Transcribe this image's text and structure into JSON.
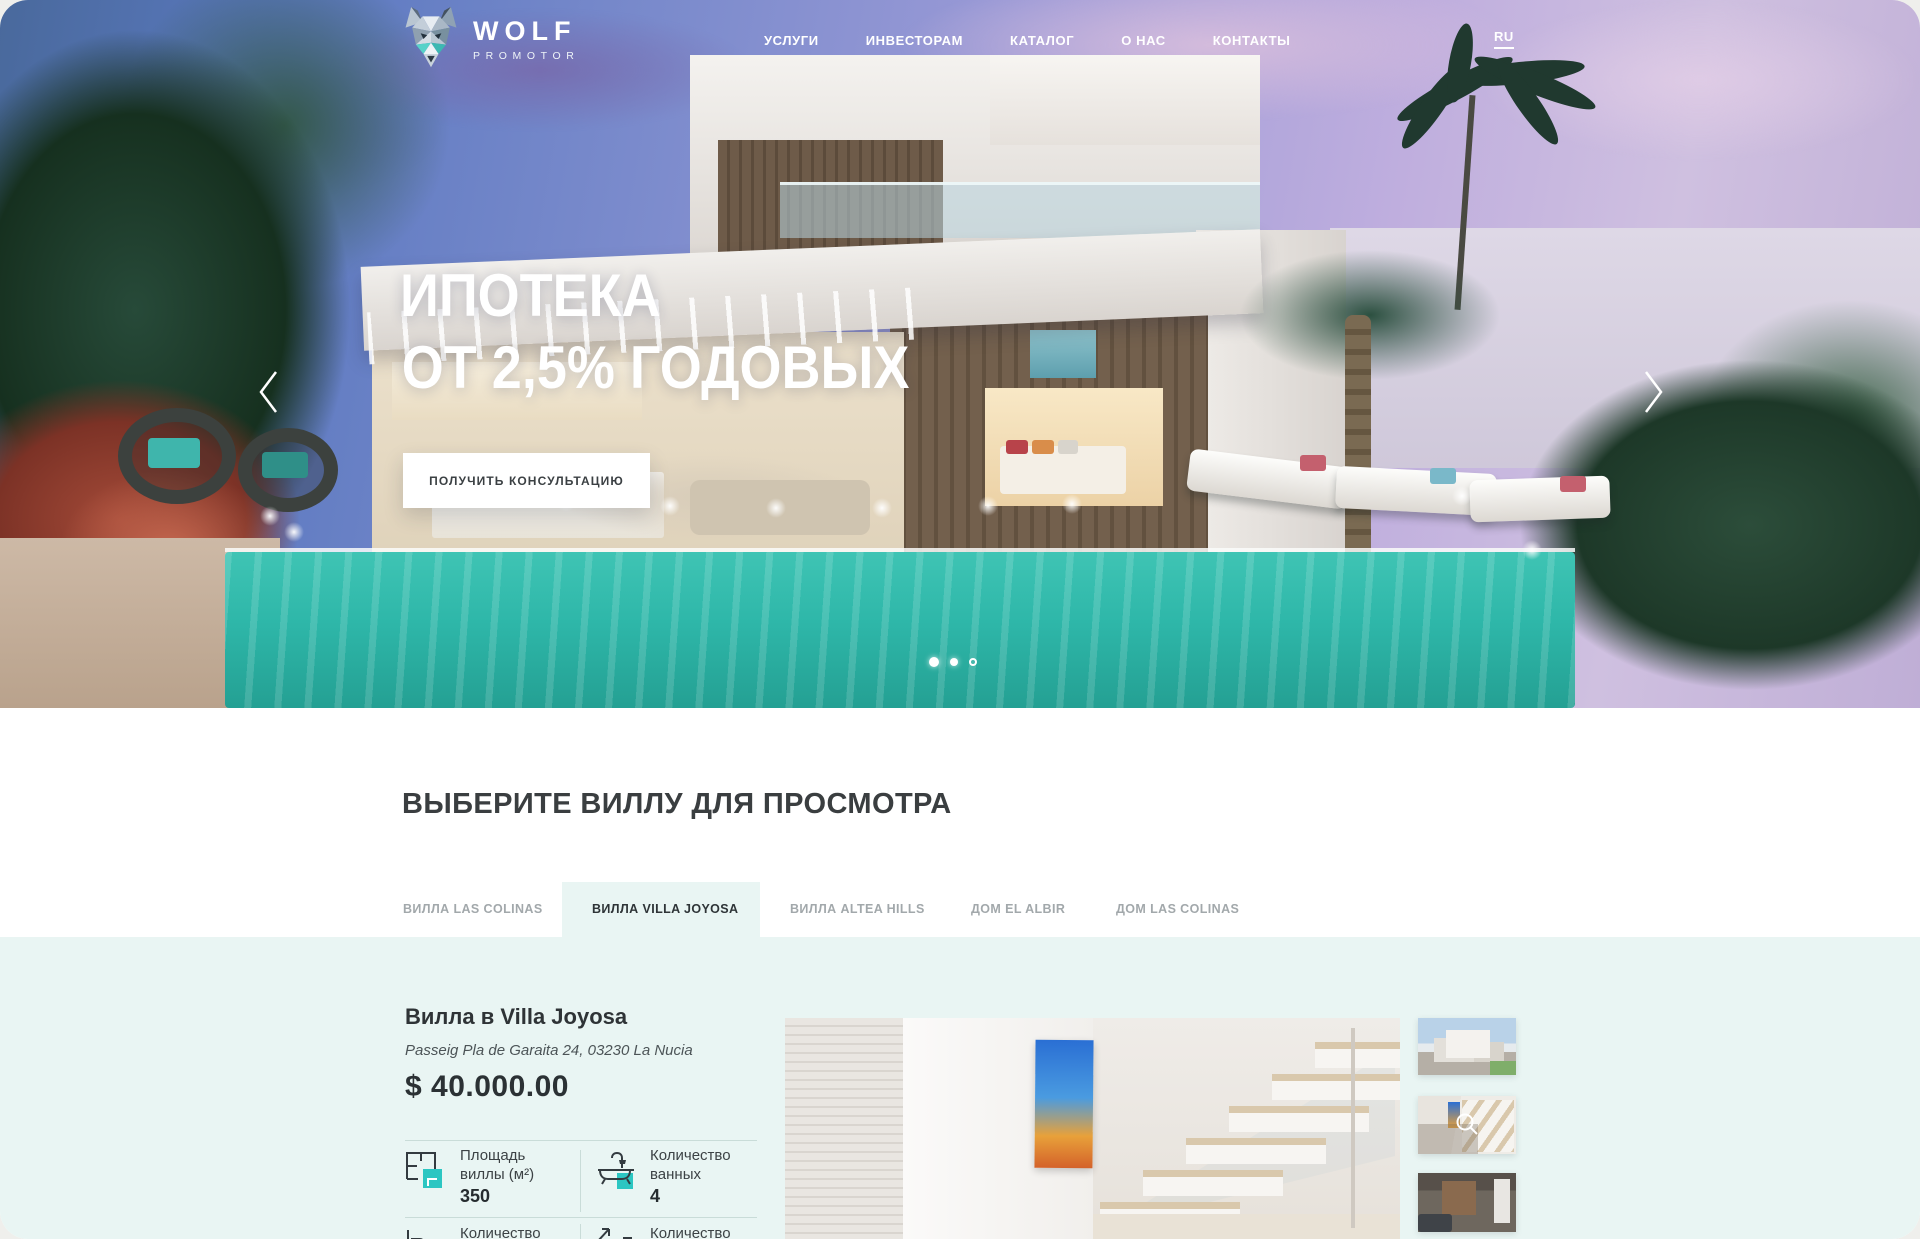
{
  "brand": {
    "name": "WOLF",
    "tagline": "PROMOTOR"
  },
  "header": {
    "nav_items": [
      {
        "label": "УСЛУГИ"
      },
      {
        "label": "ИНВЕСТОРАМ"
      },
      {
        "label": "КАТАЛОГ"
      },
      {
        "label": "О НАС"
      },
      {
        "label": "КОНТАКТЫ"
      }
    ],
    "language": "RU"
  },
  "hero": {
    "title_line1": "ИПОТЕКА",
    "title_line2": "ОТ 2,5% ГОДОВЫХ",
    "cta_label": "ПОЛУЧИТЬ КОНСУЛЬТАЦИЮ",
    "carousel": {
      "dots": [
        {
          "state": "active"
        },
        {
          "state": "solid"
        },
        {
          "state": "ring"
        }
      ]
    }
  },
  "section": {
    "heading": "ВЫБЕРИТЕ ВИЛЛУ ДЛЯ ПРОСМОТРА",
    "tabs": [
      {
        "label": "ВИЛЛА LAS COLINAS",
        "active": false
      },
      {
        "label": "ВИЛЛА VILLA JOYOSA",
        "active": true
      },
      {
        "label": "ВИЛЛА ALTEA HILLS",
        "active": false
      },
      {
        "label": "ДОМ EL ALBIR",
        "active": false
      },
      {
        "label": "ДОМ LAS COLINAS",
        "active": false
      }
    ]
  },
  "property": {
    "title": "Вилла в Villa Joyosa",
    "address": "Passeig Pla de Garaita 24, 03230 La Nucia",
    "price": "$ 40.000.00",
    "specs": [
      {
        "icon": "floorplan-icon",
        "label_line1": "Площадь",
        "label_line2": "виллы (м²)",
        "value": "350"
      },
      {
        "icon": "bathtub-icon",
        "label_line1": "Количество",
        "label_line2": "ванных",
        "value": "4"
      },
      {
        "icon": "bed-icon",
        "label_line1": "Количество",
        "label_line2": "",
        "value": ""
      },
      {
        "icon": "stairs-icon",
        "label_line1": "Количество",
        "label_line2": "",
        "value": ""
      }
    ]
  },
  "gallery": {
    "main_photo": "interior-staircase",
    "thumbnails": [
      {
        "name": "villa-exterior"
      },
      {
        "name": "interior-staircase",
        "overlay": "zoom-icon"
      },
      {
        "name": "living-room"
      }
    ]
  },
  "colors": {
    "accent_teal": "#2cc6c2",
    "mint_background": "#e9f5f3",
    "pool_teal": "#2eb7a9",
    "dark_text": "#2e3437",
    "gray_text": "#a2a8ab"
  }
}
